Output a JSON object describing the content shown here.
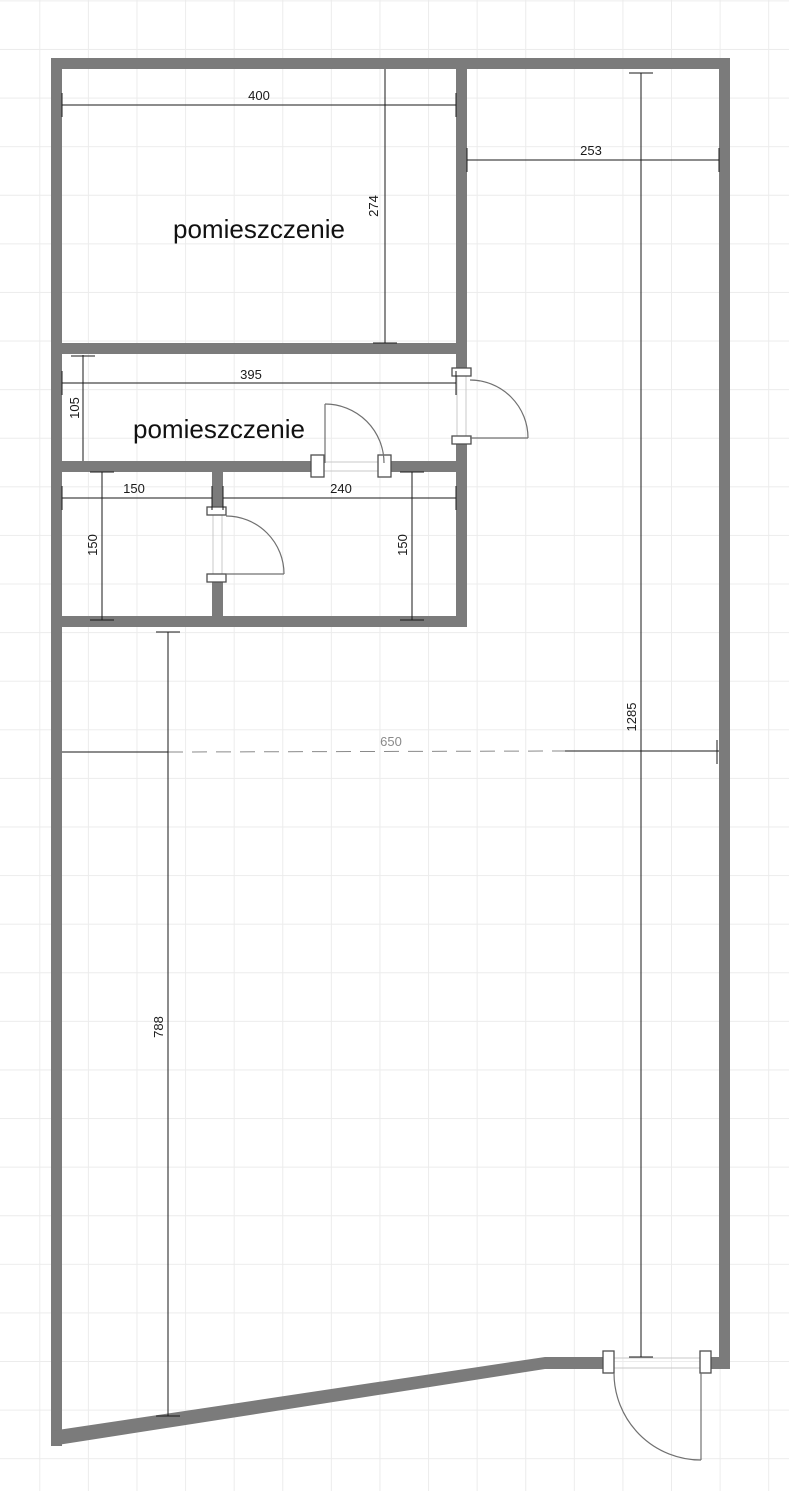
{
  "floor_plan": {
    "rooms": [
      {
        "label": "pomieszczenie"
      },
      {
        "label": "pomieszczenie"
      }
    ],
    "dimension_labels": {
      "top_room_width": "400",
      "top_room_height": "274",
      "top_corridor_width": "253",
      "middle_room_width": "395",
      "middle_room_height": "105",
      "small_room_left_width": "150",
      "small_room_left_height": "150",
      "small_room_right_width": "240",
      "small_room_right_height": "150",
      "hall_width": "650",
      "hall_height": "788",
      "overall_height": "1285"
    },
    "colors": {
      "wall": "#7b7b7b",
      "dim": "#1a1a1a",
      "dim_faded": "#8a8a8a",
      "door": "#707070",
      "jamb_border": "#4f4f4f",
      "threshold": "#c8c8c8",
      "grid": "#ececec",
      "room_label": "#111111"
    }
  }
}
